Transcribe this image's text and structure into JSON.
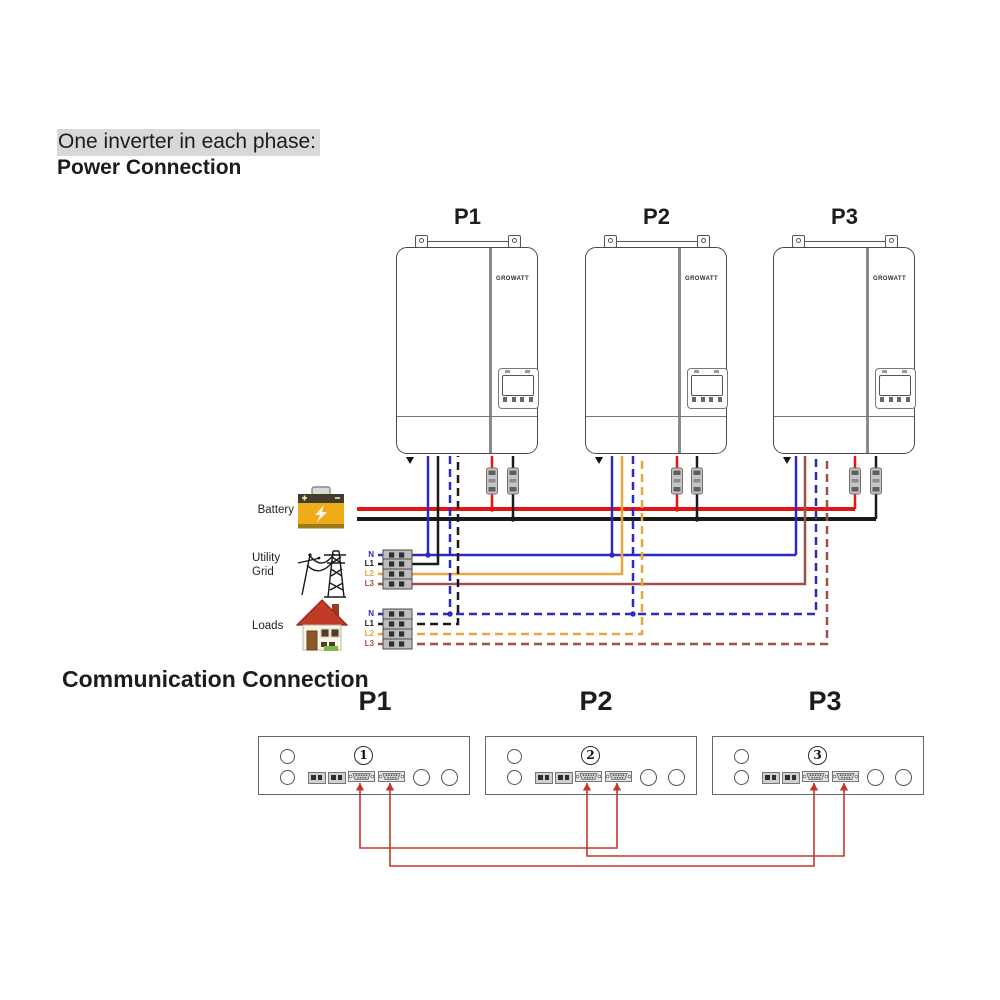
{
  "header": {
    "subtitle": "One inverter in each phase:",
    "title": "Power Connection"
  },
  "sections": {
    "communication_title": "Communication Connection"
  },
  "inverter_logo": "GROWATT",
  "inverters": [
    {
      "label": "P1"
    },
    {
      "label": "P2"
    },
    {
      "label": "P3"
    }
  ],
  "sources": {
    "battery_label": "Battery",
    "utility_label": "Utility Grid",
    "loads_label": "Loads"
  },
  "icons": {
    "battery": "battery-icon",
    "utility": "transmission-tower-icon",
    "loads": "house-icon"
  },
  "phase_labels": {
    "utility": [
      "N",
      "L1",
      "L2",
      "L3"
    ],
    "loads": [
      "N",
      "L1",
      "L2",
      "L3"
    ]
  },
  "comm": {
    "titles": [
      "P1",
      "P2",
      "P3"
    ],
    "panel_numbers": [
      "1",
      "2",
      "3"
    ]
  },
  "palette": {
    "red": "#e31616",
    "black": "#1a1a1a",
    "blue": "#2b2bbf",
    "orange": "#e9a63e",
    "brown": "#9e5148",
    "comm": "#c0392b",
    "hl": "#d8d8d8"
  },
  "diagram": {
    "wires": [
      {
        "name": "wire-battery-positive-bus",
        "color": "red",
        "width": 4,
        "dash": false,
        "points": [
          [
            357,
            509
          ],
          [
            855,
            509
          ]
        ]
      },
      {
        "name": "wire-battery-negative-bus",
        "color": "black",
        "width": 4,
        "dash": false,
        "points": [
          [
            357,
            519
          ],
          [
            876,
            519
          ]
        ]
      },
      {
        "name": "wire-p1-battery-positive",
        "color": "red",
        "width": 2.5,
        "dash": false,
        "points": [
          [
            492,
            456
          ],
          [
            492,
            509
          ]
        ]
      },
      {
        "name": "wire-p1-battery-negative",
        "color": "black",
        "width": 2.5,
        "dash": false,
        "points": [
          [
            513,
            456
          ],
          [
            513,
            519
          ]
        ]
      },
      {
        "name": "wire-p2-battery-positive",
        "color": "red",
        "width": 2.5,
        "dash": false,
        "points": [
          [
            677,
            456
          ],
          [
            677,
            509
          ]
        ]
      },
      {
        "name": "wire-p2-battery-negative",
        "color": "black",
        "width": 2.5,
        "dash": false,
        "points": [
          [
            697,
            456
          ],
          [
            697,
            519
          ]
        ]
      },
      {
        "name": "wire-p3-battery-positive",
        "color": "red",
        "width": 2.5,
        "dash": false,
        "points": [
          [
            855,
            456
          ],
          [
            855,
            509
          ]
        ]
      },
      {
        "name": "wire-p3-battery-negative",
        "color": "black",
        "width": 2.5,
        "dash": false,
        "points": [
          [
            876,
            456
          ],
          [
            876,
            519
          ]
        ]
      },
      {
        "name": "wire-utility-neutral",
        "color": "blue",
        "width": 2.5,
        "dash": false,
        "points": [
          [
            378,
            555
          ],
          [
            796,
            555
          ]
        ]
      },
      {
        "name": "wire-p1-utility-neutral",
        "color": "blue",
        "width": 2.5,
        "dash": false,
        "points": [
          [
            428,
            456
          ],
          [
            428,
            555
          ]
        ]
      },
      {
        "name": "wire-p2-utility-neutral",
        "color": "blue",
        "width": 2.5,
        "dash": false,
        "points": [
          [
            612,
            456
          ],
          [
            612,
            555
          ]
        ]
      },
      {
        "name": "wire-p3-utility-neutral",
        "color": "blue",
        "width": 2.5,
        "dash": false,
        "points": [
          [
            796,
            456
          ],
          [
            796,
            555
          ]
        ]
      },
      {
        "name": "wire-utility-l1",
        "color": "black",
        "width": 2.5,
        "dash": false,
        "points": [
          [
            378,
            564
          ],
          [
            438,
            564
          ],
          [
            438,
            456
          ]
        ]
      },
      {
        "name": "wire-utility-l2",
        "color": "orange",
        "width": 2.5,
        "dash": false,
        "points": [
          [
            378,
            574
          ],
          [
            622,
            574
          ],
          [
            622,
            456
          ]
        ]
      },
      {
        "name": "wire-utility-l3",
        "color": "brown",
        "width": 2.5,
        "dash": false,
        "points": [
          [
            378,
            584
          ],
          [
            805,
            584
          ],
          [
            805,
            456
          ]
        ]
      },
      {
        "name": "wire-loads-neutral",
        "color": "blue",
        "width": 2.5,
        "dash": true,
        "points": [
          [
            378,
            614
          ],
          [
            816,
            614
          ],
          [
            816,
            456
          ]
        ]
      },
      {
        "name": "wire-p1-loads-neutral",
        "color": "blue",
        "width": 2.5,
        "dash": true,
        "points": [
          [
            450,
            456
          ],
          [
            450,
            614
          ]
        ]
      },
      {
        "name": "wire-p2-loads-neutral",
        "color": "blue",
        "width": 2.5,
        "dash": true,
        "points": [
          [
            633,
            456
          ],
          [
            633,
            614
          ]
        ]
      },
      {
        "name": "wire-loads-l1",
        "color": "black",
        "width": 2.5,
        "dash": true,
        "points": [
          [
            378,
            624
          ],
          [
            458,
            624
          ],
          [
            458,
            456
          ]
        ]
      },
      {
        "name": "wire-loads-l2",
        "color": "orange",
        "width": 2.5,
        "dash": true,
        "points": [
          [
            378,
            634
          ],
          [
            642,
            634
          ],
          [
            642,
            456
          ]
        ]
      },
      {
        "name": "wire-loads-l3",
        "color": "brown",
        "width": 2.5,
        "dash": true,
        "points": [
          [
            378,
            644
          ],
          [
            827,
            644
          ],
          [
            827,
            456
          ]
        ]
      },
      {
        "name": "comm-cable-p1-p2",
        "color": "comm",
        "width": 1.6,
        "dash": false,
        "points": [
          [
            360,
            783
          ],
          [
            360,
            848
          ],
          [
            617,
            848
          ],
          [
            617,
            783
          ]
        ]
      },
      {
        "name": "comm-cable-p2-p3",
        "color": "comm",
        "width": 1.6,
        "dash": false,
        "points": [
          [
            587,
            783
          ],
          [
            587,
            856
          ],
          [
            844,
            856
          ],
          [
            844,
            783
          ]
        ]
      },
      {
        "name": "comm-cable-p1-p3",
        "color": "comm",
        "width": 1.6,
        "dash": false,
        "points": [
          [
            390,
            783
          ],
          [
            390,
            866
          ],
          [
            814,
            866
          ],
          [
            814,
            783
          ]
        ]
      }
    ],
    "fuses": [
      {
        "x": 492
      },
      {
        "x": 513
      },
      {
        "x": 677
      },
      {
        "x": 697
      },
      {
        "x": 855
      },
      {
        "x": 876
      }
    ],
    "breakers": {
      "x": 383,
      "w": 29,
      "h": 10,
      "rows": [
        555,
        564,
        574,
        584,
        614,
        624,
        634,
        644
      ]
    },
    "dots": [
      {
        "x": 428,
        "y": 555,
        "c": "blue"
      },
      {
        "x": 612,
        "y": 555,
        "c": "blue"
      },
      {
        "x": 450,
        "y": 614,
        "c": "blue"
      },
      {
        "x": 633,
        "y": 614,
        "c": "blue"
      },
      {
        "x": 492,
        "y": 509,
        "c": "red"
      },
      {
        "x": 677,
        "y": 509,
        "c": "red"
      },
      {
        "x": 513,
        "y": 519,
        "c": "black"
      },
      {
        "x": 697,
        "y": 519,
        "c": "black"
      }
    ],
    "comm_arrows": [
      {
        "x": 360,
        "y": 783
      },
      {
        "x": 617,
        "y": 783
      },
      {
        "x": 587,
        "y": 783
      },
      {
        "x": 844,
        "y": 783
      },
      {
        "x": 390,
        "y": 783
      },
      {
        "x": 814,
        "y": 783
      }
    ]
  }
}
